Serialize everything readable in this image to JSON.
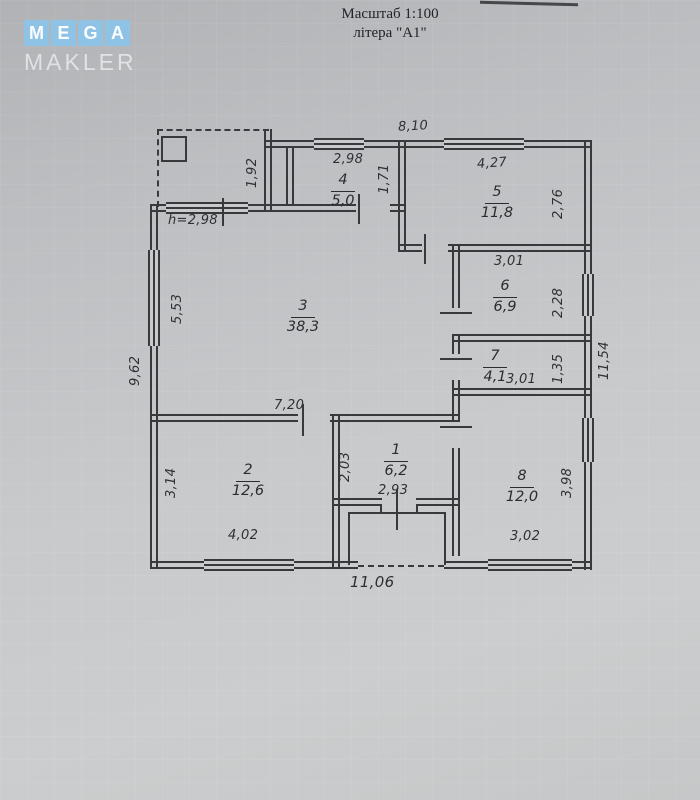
{
  "header": {
    "scale_text": "Масштаб 1:100",
    "litera_text": "літера \"А1\""
  },
  "logo": {
    "tiles": [
      "M",
      "E",
      "G",
      "A"
    ],
    "subtitle": "MAKLER"
  },
  "rooms": [
    {
      "num": "1",
      "area": "6,2"
    },
    {
      "num": "2",
      "area": "12,6"
    },
    {
      "num": "3",
      "area": "38,3"
    },
    {
      "num": "4",
      "area": "5,0"
    },
    {
      "num": "5",
      "area": "11,8"
    },
    {
      "num": "6",
      "area": "6,9"
    },
    {
      "num": "7",
      "area": "4,1"
    },
    {
      "num": "8",
      "area": "12,0"
    }
  ],
  "dims": {
    "top_width": "8,10",
    "room4_width": "2,98",
    "room4_depth": "1,71",
    "veranda_side": "1,92",
    "room5_width": "4,27",
    "room5_depth": "2,76",
    "room6_width": "3,01",
    "room6_depth": "2,28",
    "room7_width": "3,01",
    "room7_depth": "1,35",
    "right_side_total": "11,54",
    "height_note": "h=2,98",
    "room3_side": "5,53",
    "left_side_total": "9,62",
    "room3_width": "7,20",
    "room2_depth": "3,14",
    "room2_width": "4,02",
    "room1_depth": "2,03",
    "room1_width": "2,93",
    "room8_depth": "3,98",
    "room8_width": "3,02",
    "bottom_total": "11,06"
  }
}
